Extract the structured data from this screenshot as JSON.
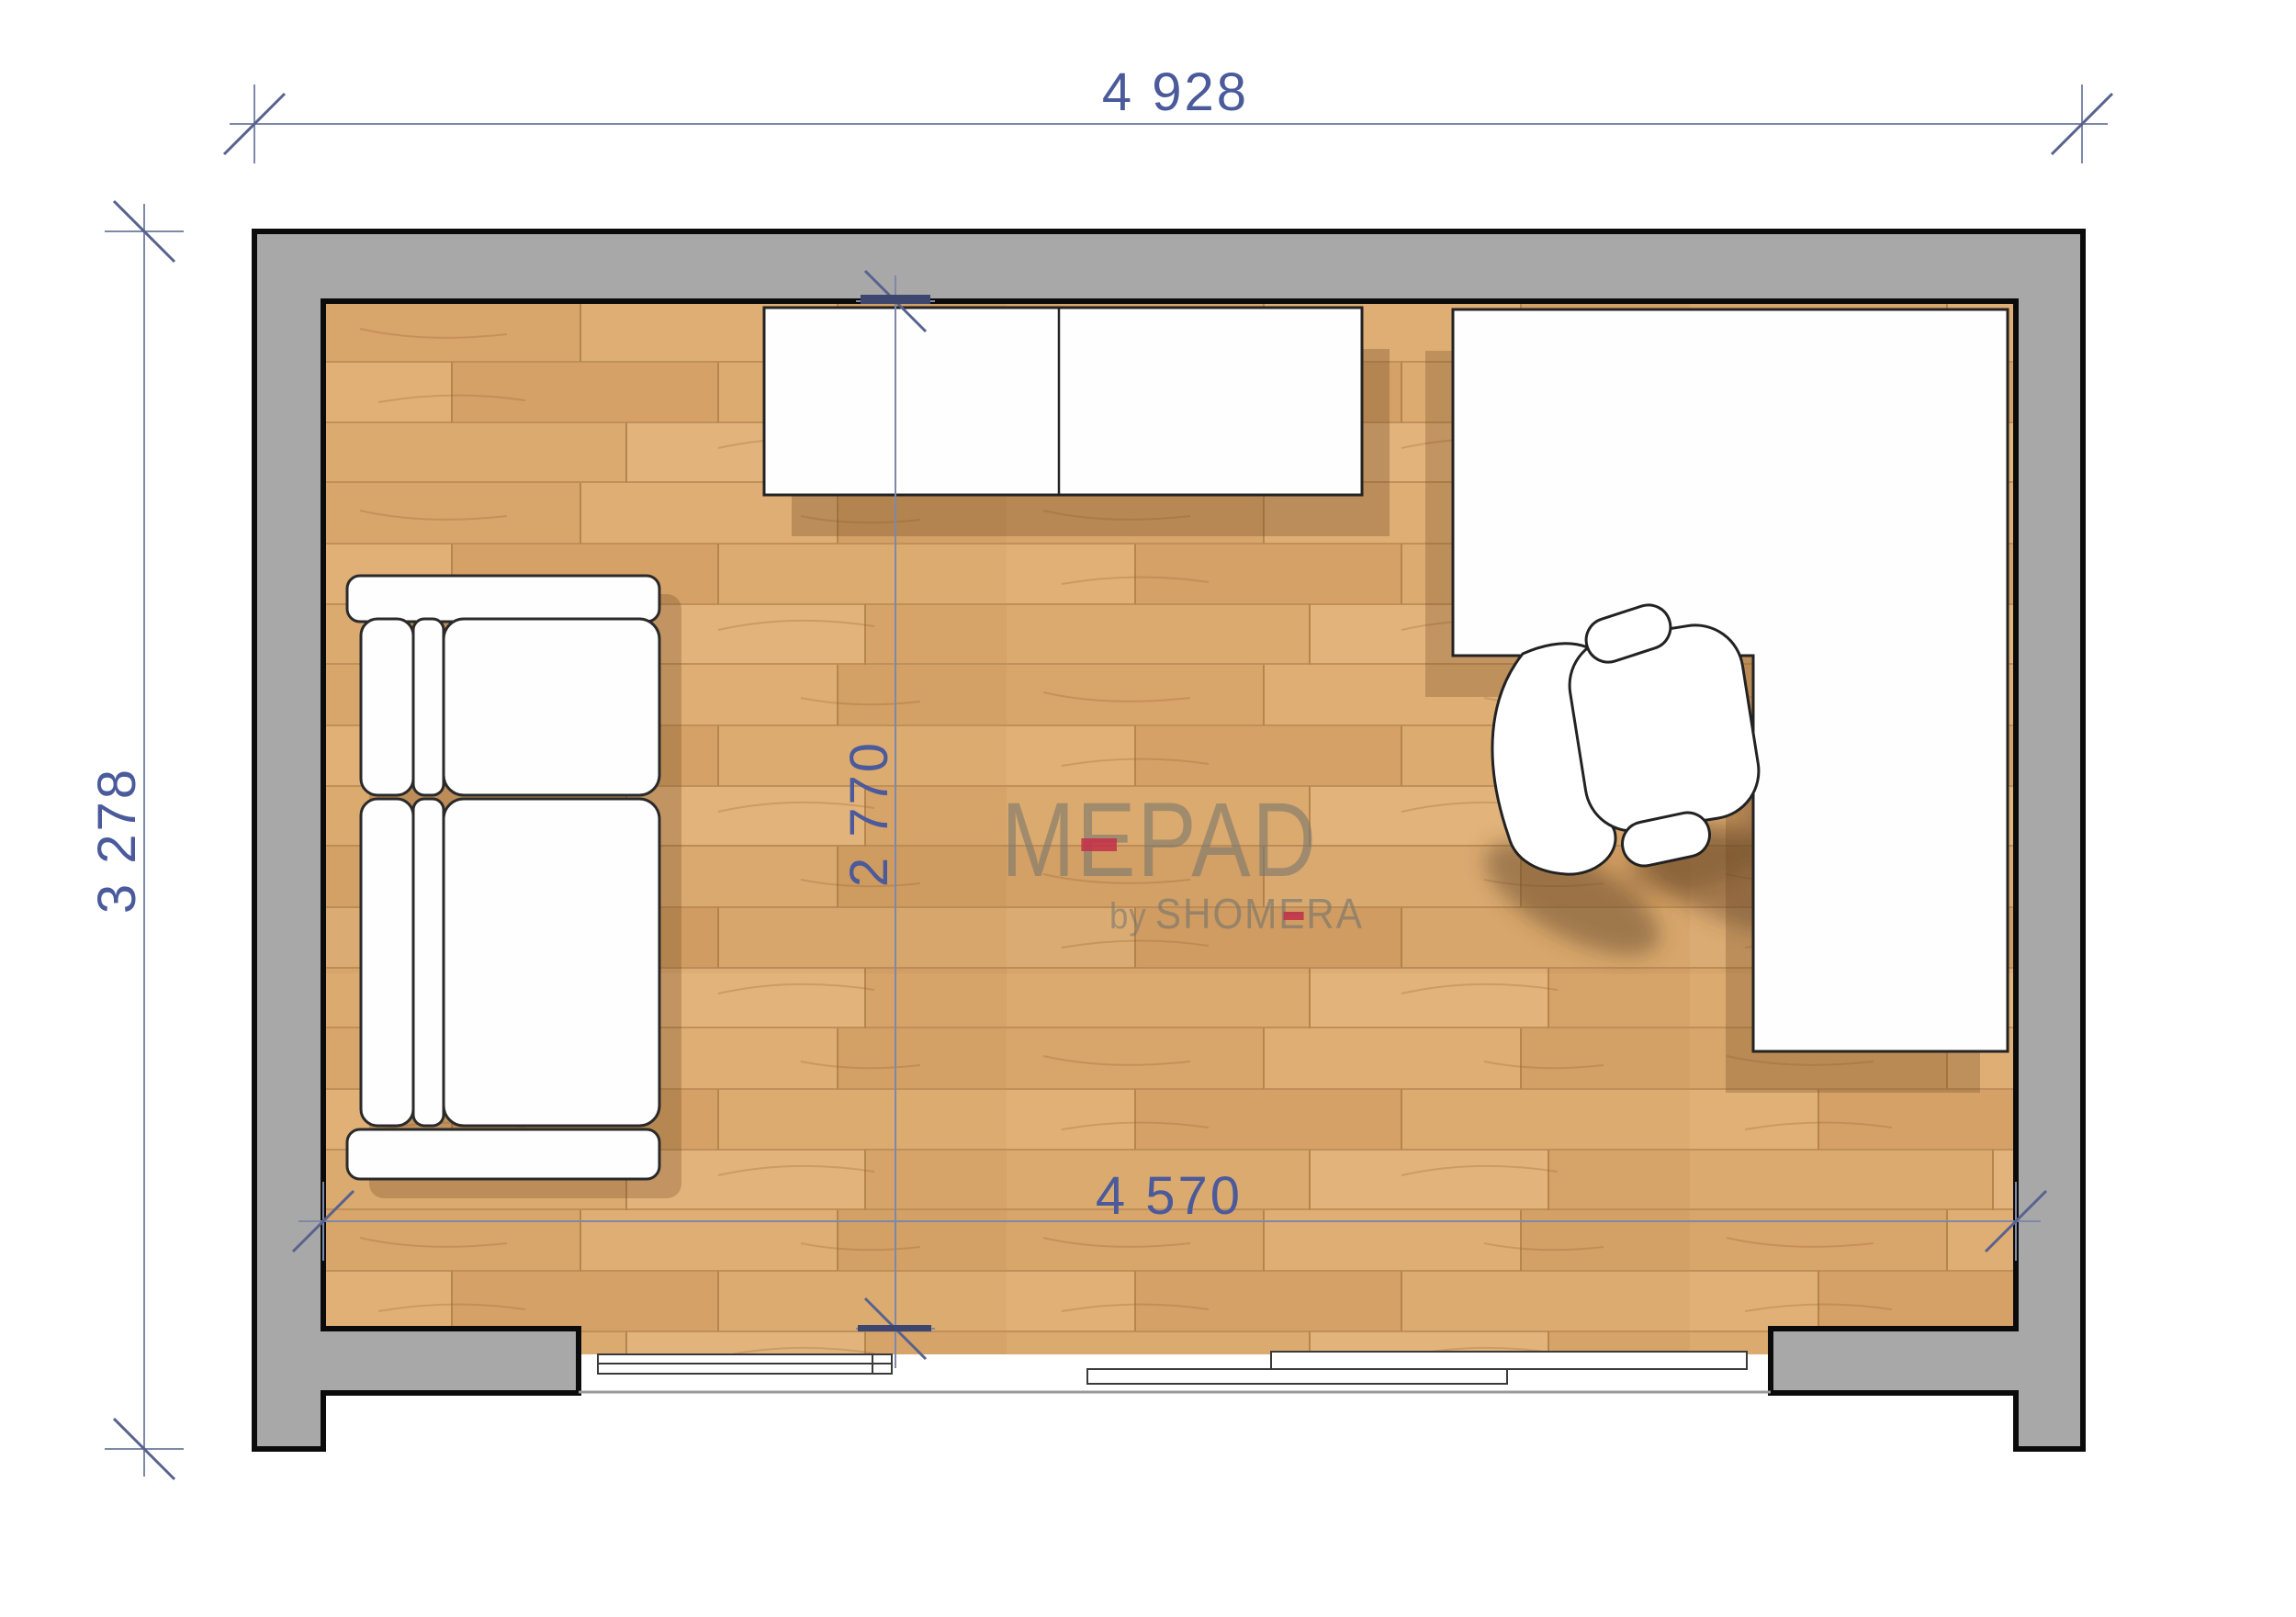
{
  "dimensions": {
    "outer_width": "4 928",
    "outer_height": "3 278",
    "interior_height": "2 770",
    "interior_width": "4 570"
  },
  "logo": {
    "name": "MEPAD",
    "by": "by",
    "brand": "SHOMERA"
  },
  "colors": {
    "dimension_text_blue": "#4b5a9b",
    "dimension_line_blue": "#7e88a8",
    "accent_red": "#c23249",
    "wall_gray": "#a8a8a8",
    "wall_outline_black": "#0b0b0b",
    "floor_wood_tan": "#d8a56a",
    "furniture_white": "#fefefe",
    "shadow_brown": "rgba(115,75,38,0.33)"
  }
}
